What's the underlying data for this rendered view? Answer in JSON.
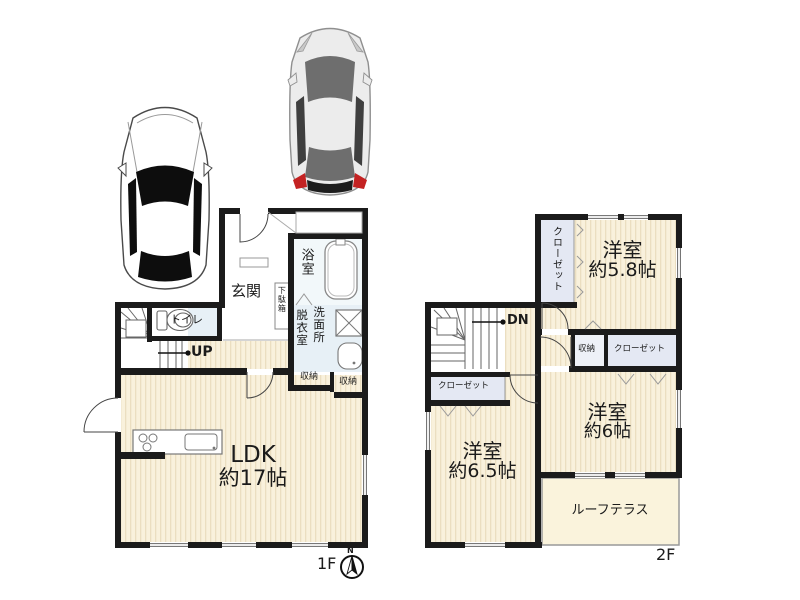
{
  "title": "2-story house floor plan with parking",
  "colors": {
    "wall": "#1b1b1b",
    "floor_cream": "#f9f1dc",
    "floor_stripe": "#ebdec0",
    "wet_area": "#e7f0f6",
    "bath_area": "#f2f8fa",
    "closet": "#e4e8f3",
    "terrace": "#faf3dc",
    "car_body_silver": "#ececec",
    "car_glass_dark": "#6e6e6e",
    "taillight_red": "#c42222"
  },
  "compass": {
    "north_label": "N"
  },
  "floor1": {
    "floor_label": "1F",
    "entrance": "玄関",
    "shoe_cabinet": "下駄箱",
    "bathroom": "浴室",
    "toilet": "トイレ",
    "stairs_up": "UP",
    "dressing_room": "脱衣室",
    "washroom": "洗面所",
    "storage_a": "収納",
    "storage_b": "収納",
    "ldk_name": "LDK",
    "ldk_size": "約17帖"
  },
  "floor2": {
    "floor_label": "2F",
    "closet_northwest": "クローゼット",
    "room58_name": "洋室",
    "room58_size": "約5.8帖",
    "stairs_down": "DN",
    "storage": "収納",
    "closet_east": "クローゼット",
    "closet_west": "クローゼット",
    "room65_name": "洋室",
    "room65_size": "約6.5帖",
    "room6_name": "洋室",
    "room6_size": "約6帖",
    "roof_terrace": "ルーフテラス"
  }
}
